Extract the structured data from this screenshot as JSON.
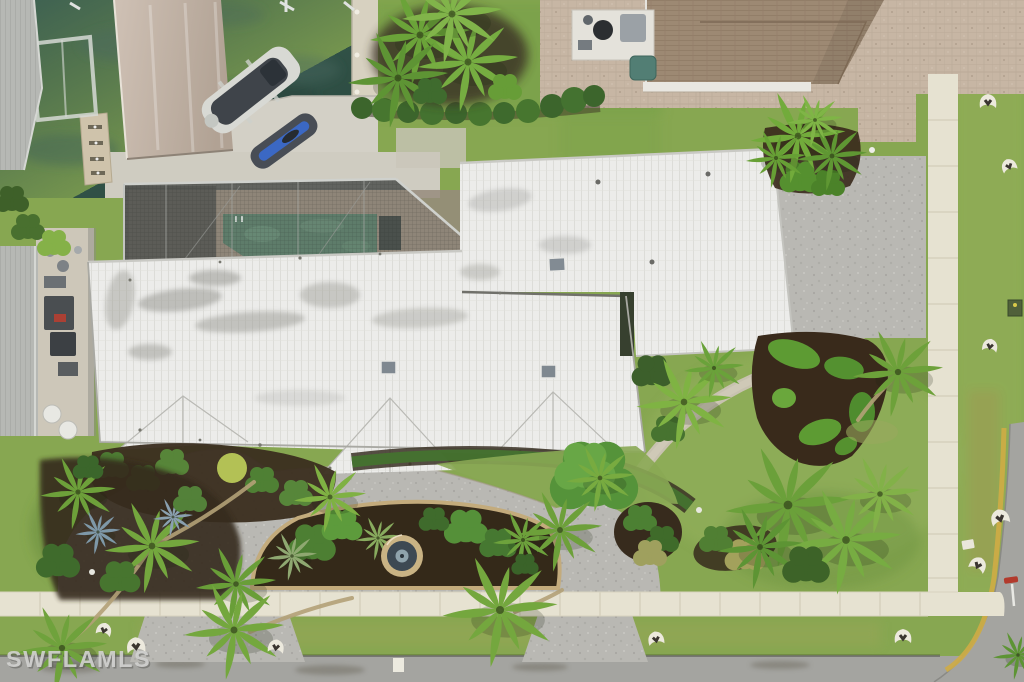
{
  "watermark": {
    "text": "SWFLAMLS"
  },
  "scene": {
    "type": "aerial-drone-photo",
    "description": "Overhead aerial photo of a waterfront home with white tile roof, screened pool enclosure, covered boat dock on a canal, circular paver driveway with fountain island, tropical landscaping, neighboring brown-roof house, sidewalks and street corner",
    "elements": [
      "canal-water",
      "covered-boat-slip",
      "boat",
      "kayak",
      "finger-pier",
      "seawall",
      "pool-enclosure",
      "swimming-pool",
      "main-house-white-tile-roof",
      "skylights",
      "neighbor-house-roof",
      "pool-equipment-pad",
      "tan-paver-driveway",
      "gray-paver-courtyard",
      "circular-front-driveway",
      "fountain-island",
      "stone-garden-path",
      "sculpted-shrub-bed",
      "palm-trees",
      "sidewalk",
      "street",
      "yellow-curb",
      "lawn-ornaments",
      "utility-marker",
      "watermark"
    ]
  },
  "palette": {
    "water": "#33544a",
    "lawn": "#87a751",
    "roof_white": "#ececea",
    "roof_neighbor": "#9d8973",
    "paver_tan": "#c7b6a4",
    "paver_gray": "#b9b8b3",
    "sidewalk": "#e6e2d1",
    "street": "#a4a4a0",
    "mulch": "#38291b",
    "pool_water": "#5e7c6a",
    "kayak_blue": "#3b68c4",
    "curb_yellow": "#cfac45",
    "watermark_gray": "#d2d2d0"
  }
}
